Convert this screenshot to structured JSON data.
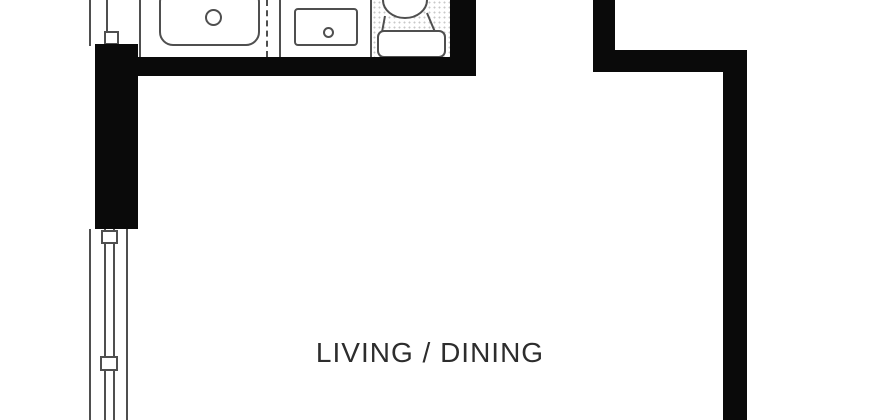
{
  "floorplan": {
    "rooms": [
      {
        "label": "LIVING / DINING"
      }
    ],
    "fixtures": [
      "kitchen-sink",
      "kitchen-basin",
      "toilet"
    ],
    "symbols": [
      "window",
      "window-mullion",
      "wall",
      "counter-divider-dashed",
      "stipple-floor"
    ],
    "colors": {
      "wall": "#0a0a0a",
      "fixture_line": "#4f4f4f",
      "label_text": "#2d2d2d",
      "background": "#ffffff",
      "stipple_dot": "#c8c8c8"
    }
  }
}
